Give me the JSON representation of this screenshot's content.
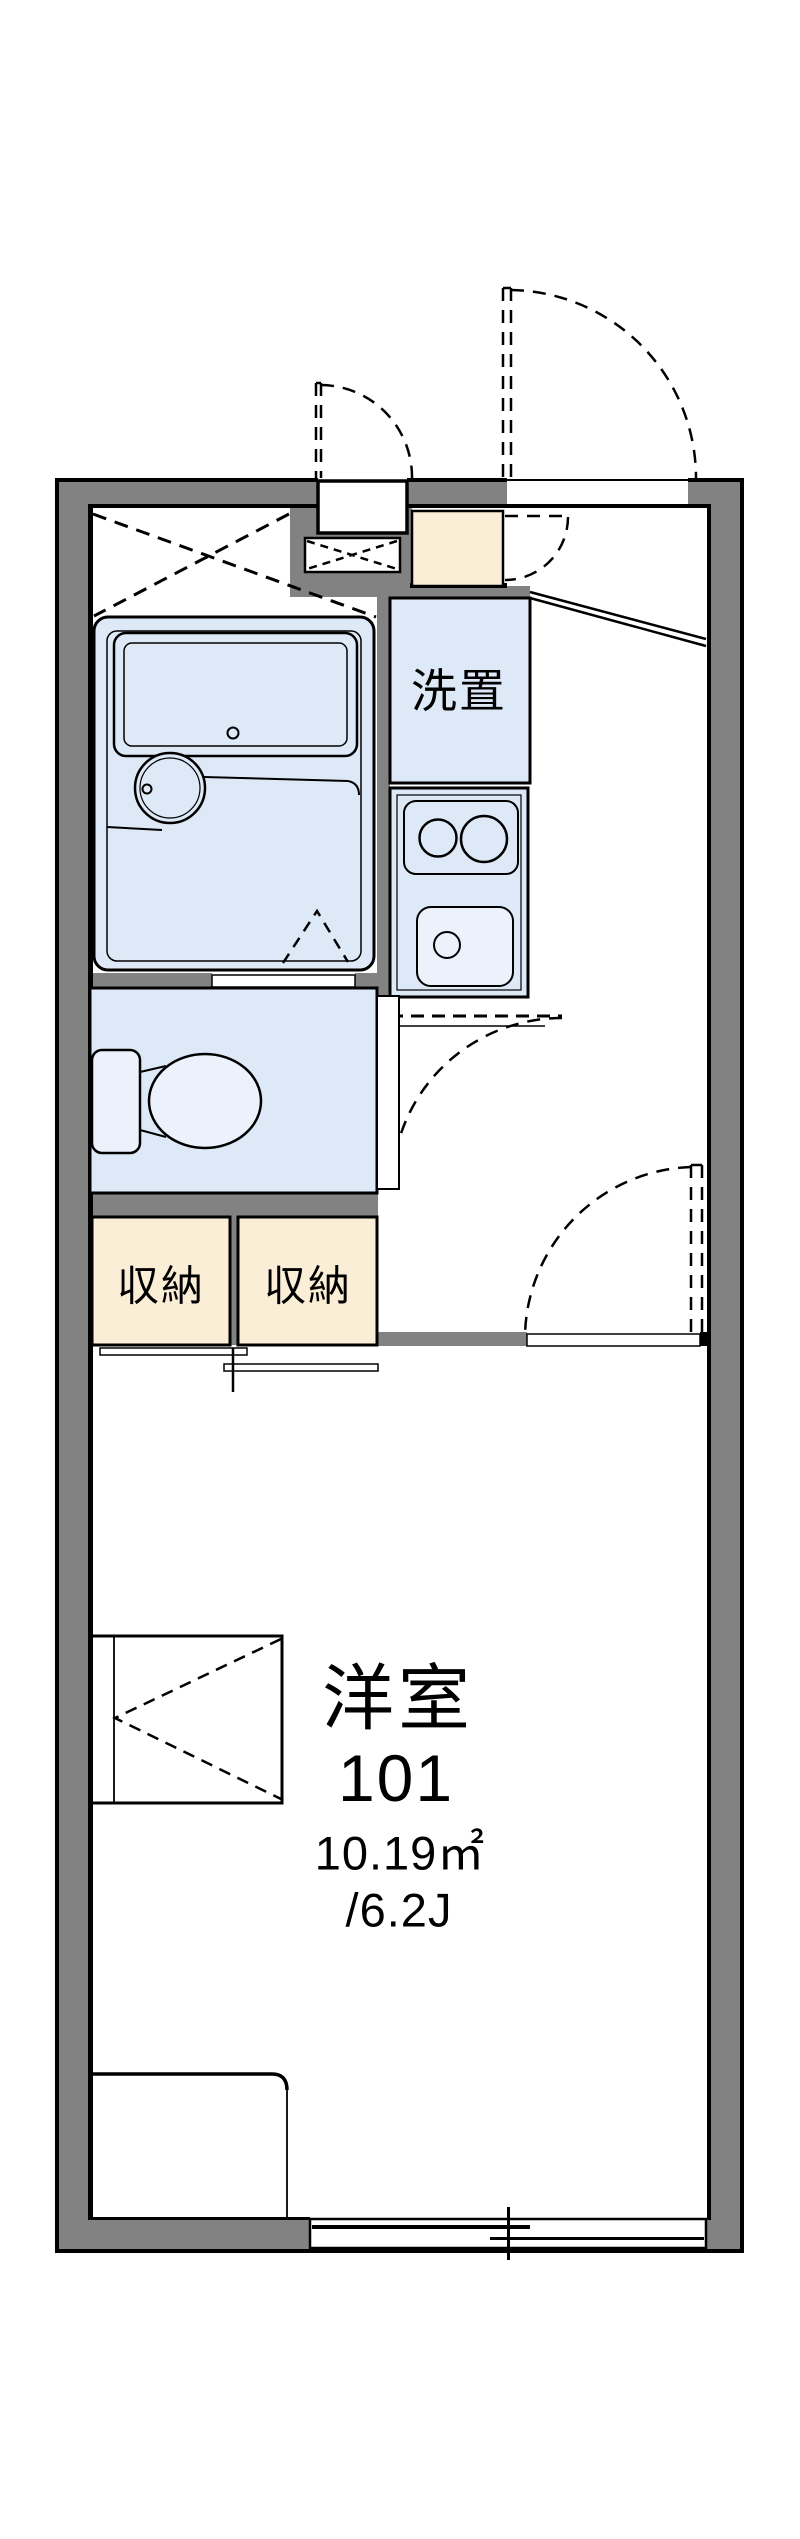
{
  "floorplan": {
    "room": {
      "name": "洋室",
      "number": "101",
      "area_sqm": "10.19㎡",
      "area_tatami": "/6.2J"
    },
    "labels": {
      "laundry": "洗置",
      "storage_left": "収納",
      "storage_right": "収納"
    },
    "colors": {
      "wall": "#828282",
      "fixture_fill": "#dee9f8",
      "fixture_fill_light": "#ecf2fb",
      "storage_fill": "#fbeed6",
      "line": "#000000",
      "background": "#ffffff"
    }
  }
}
